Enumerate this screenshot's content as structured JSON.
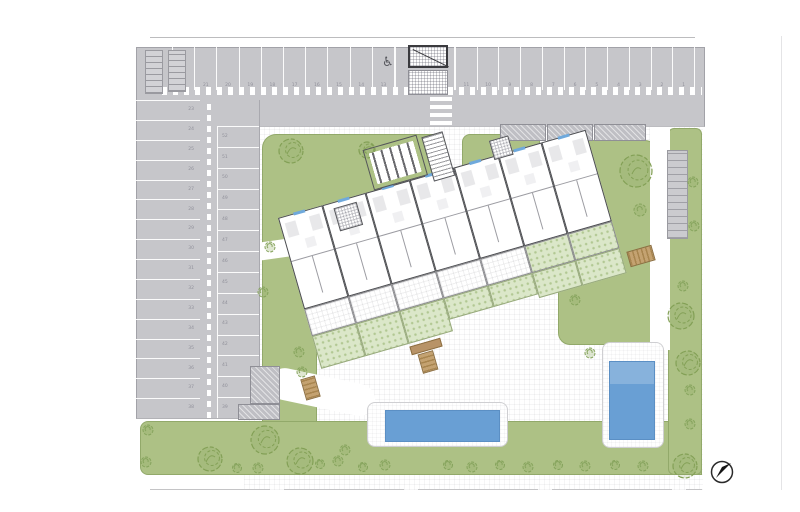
{
  "meta": {
    "type": "architectural-site-plan",
    "compass_direction": "NE"
  },
  "colors": {
    "paper": "#ffffff",
    "parking_gray": "#c6c6ca",
    "green": "#adc185",
    "garden_green": "#dbe7c9",
    "pool_blue": "#699fd4",
    "stair_tan": "#b3905e",
    "wall_dark": "#4b4c50",
    "window_blue": "#6fa9dc"
  },
  "parking": {
    "handicap_icon": "♿",
    "top_row_left_numbers": [
      "22",
      "21",
      "20",
      "19",
      "18",
      "17",
      "16",
      "15",
      "14",
      "13"
    ],
    "top_row_right_numbers": [
      "11",
      "10",
      "9",
      "8",
      "7",
      "6",
      "5",
      "4",
      "3",
      "2",
      "1"
    ],
    "west_outer_numbers": [
      "23",
      "24",
      "25",
      "26",
      "27",
      "28",
      "29",
      "30",
      "31",
      "32",
      "33",
      "34",
      "35",
      "36",
      "37",
      "38"
    ],
    "west_inner_numbers": [
      "52",
      "51",
      "50",
      "49",
      "48",
      "47",
      "46",
      "45",
      "44",
      "43",
      "42",
      "41",
      "40",
      "39"
    ]
  },
  "building": {
    "units": [
      {
        "terrace": "paved",
        "garden": 34
      },
      {
        "terrace": "paved",
        "garden": 34
      },
      {
        "terrace": "paved",
        "garden": 34
      },
      {
        "terrace": "paved",
        "garden": 22
      },
      {
        "terrace": "paved",
        "garden": 22
      },
      {
        "terrace": "green",
        "garden": 26
      },
      {
        "terrace": "green",
        "garden": 26
      }
    ]
  },
  "landscape": {
    "trees": [
      [
        291,
        151,
        12
      ],
      [
        367,
        150,
        8
      ],
      [
        636,
        171,
        16
      ],
      [
        265,
        440,
        14
      ],
      [
        210,
        459,
        12
      ],
      [
        300,
        461,
        13
      ],
      [
        681,
        316,
        13
      ],
      [
        688,
        363,
        12
      ],
      [
        685,
        466,
        12
      ]
    ],
    "bushes": [
      [
        270,
        247,
        5
      ],
      [
        263,
        292,
        5
      ],
      [
        299,
        352,
        5
      ],
      [
        302,
        372,
        5
      ],
      [
        693,
        182,
        5
      ],
      [
        694,
        226,
        5
      ],
      [
        683,
        286,
        5
      ],
      [
        690,
        390,
        5
      ],
      [
        690,
        424,
        5
      ],
      [
        640,
        210,
        6
      ],
      [
        590,
        353,
        5
      ],
      [
        575,
        300,
        5
      ],
      [
        345,
        450,
        5
      ],
      [
        363,
        467,
        4.5
      ],
      [
        385,
        465,
        5
      ],
      [
        448,
        465,
        4.5
      ],
      [
        472,
        467,
        5
      ],
      [
        500,
        465,
        4.5
      ],
      [
        528,
        467,
        5
      ],
      [
        558,
        465,
        4.5
      ],
      [
        585,
        466,
        5
      ],
      [
        615,
        465,
        4.5
      ],
      [
        643,
        466,
        5
      ],
      [
        148,
        430,
        5
      ],
      [
        146,
        462,
        5
      ],
      [
        237,
        468,
        4.5
      ],
      [
        258,
        468,
        5
      ],
      [
        320,
        464,
        4.5
      ],
      [
        338,
        461,
        5
      ]
    ]
  }
}
